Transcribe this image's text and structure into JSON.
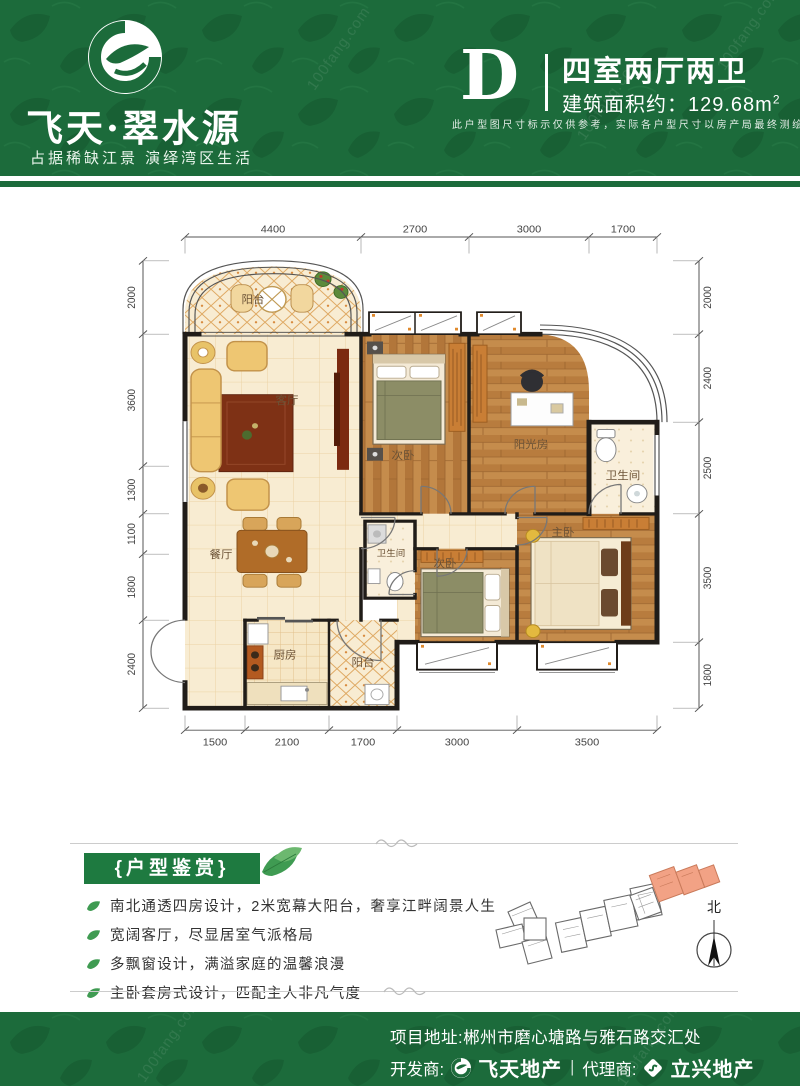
{
  "watermark": "100fang.com",
  "colors": {
    "brand_green": "#1c6b3b",
    "badge_green": "#1e7a40",
    "highlight_salmon": "#f2a285"
  },
  "header": {
    "title": "飞天·翠水源",
    "subtitle": "占据稀缺江景 演绎湾区生活",
    "unit_letter": "D",
    "unit_type": "四室两厅两卫",
    "area_prefix": "建筑面积约：",
    "area_value": "129.68",
    "area_unit": "m",
    "area_sup": "2",
    "disclaimer": "此户型图尺寸标示仅供参考，实际各户型尺寸以房产局最终测绘为准"
  },
  "floorplan": {
    "rooms": {
      "balcony_top": "阳台",
      "living": "客厅",
      "bedroom_top": "次卧",
      "sunroom": "阳光房",
      "bath_right": "卫生间",
      "dining": "餐厅",
      "bath_mid": "卫生间",
      "bedroom_bottom": "次卧",
      "master": "主卧",
      "kitchen": "厨房",
      "balcony_bottom": "阳台"
    },
    "dims": {
      "top": [
        "4400",
        "2700",
        "3000",
        "1700"
      ],
      "bottom": [
        "1500",
        "2100",
        "1700",
        "3000",
        "3500"
      ],
      "left": [
        "2000",
        "3600",
        "1300",
        "1100",
        "1800",
        "2400"
      ],
      "right": [
        "2000",
        "2400",
        "2500",
        "3500",
        "1800"
      ]
    }
  },
  "appreciation": {
    "badge": "{户型鉴赏}",
    "points": [
      "南北通透四房设计，2米宽幕大阳台，奢享江畔阔景人生",
      "宽阔客厅，尽显居室气派格局",
      "多飘窗设计，满溢家庭的温馨浪漫",
      "主卧套房式设计，匹配主人非凡气度"
    ]
  },
  "siteplan": {
    "north": "北"
  },
  "footer": {
    "address": "项目地址:郴州市磨心塘路与雅石路交汇处",
    "developer_label": "开发商:",
    "developer_name": "飞天地产",
    "separator": "|",
    "agent_label": "代理商:",
    "agent_name": "立兴地产"
  }
}
